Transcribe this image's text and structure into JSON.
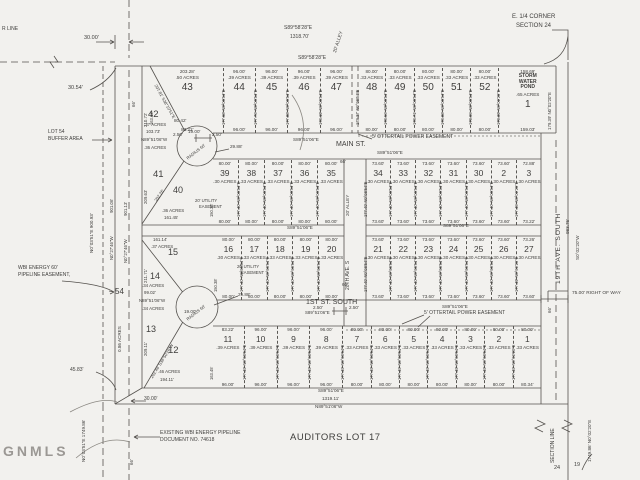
{
  "colors": {
    "bg": "#f2f1ee",
    "ink": "#3f3e3c",
    "line": "#55524e",
    "watermark": "#9b9894"
  },
  "watermark": "GNMLS",
  "an": {
    "r_line": "R LINE",
    "d30_top": "30.00'",
    "d30_54": "30.54'",
    "lot54_l1": "LOT 54",
    "lot54_l2": "BUFFER AREA",
    "b_top1": "S89°58'28\"E",
    "b_top1d": "1318.70'",
    "b_top2": "S89°58'28\"E",
    "alley_top": "20' ALLEY",
    "e14_l1": "E. 1/4 CORNER",
    "e14_l2": "SECTION 24",
    "d80_42": "80.42'",
    "d19_u": "19.00'",
    "d2_50a": "2.50'",
    "d2_50b": "2.50'",
    "d29_88u": "29.88'",
    "radius_u": "RADIUS 60'",
    "radius_l": "RADIUS 60'",
    "main_st": "MAIN ST.",
    "b_main_w": "S89°51'06\"E",
    "b_main_e": "S89°51'06\"E",
    "ott_u": "5' OTTERTAIL POWER EASEMENT",
    "ott_l": "5' OTTERTAIL POWER EASEMENT",
    "u1": ".37 ACRES",
    "u2": "103.73'",
    "u3": "N89°51'06\"W",
    "u4": ".36 ACRES",
    "l1": ".34 ACRES",
    "l2": "99.02'",
    "l3": "N89°51'06\"W",
    "l4": ".34 ACRES",
    "b_mid_w": "S89°51'06\"E",
    "b_mid_e": "S89°51'06\"E",
    "util_1a": "20' UTILITY",
    "util_1b": "EASEMENT",
    "util_2a": "20' UTILITY",
    "util_2b": "EASEMENT",
    "alley_mid": "20' ALLEY",
    "ave20": "20TH AVE. S",
    "first_st": "1ST ST. SOUTH",
    "b_1st": "S89°51'06\"E",
    "b_1st_e": "S89°51'06\"E",
    "d2_50c": "2.50'",
    "d2_50d": "2.50'",
    "d29_88l": "29.88'",
    "d19_l": "19.00'",
    "d66_a": "66'",
    "d66_b": "66'",
    "d66_c": "66'",
    "d66_d": "66'",
    "d66_e": "66'",
    "ave19": "19TH AVE. SOUTH",
    "d983": "983.76'",
    "b_s002": "S0°02'20\"W",
    "d179_39": "179.39' N0°02'20\"E",
    "row_txt": "75.00' RIGHT OF WAY",
    "section_line": "SECTION LINE",
    "d1749_e": "1749.86' N0°02'20\"E",
    "n24": "24",
    "n19": "19",
    "b_bot1": "S89°51'06\"E",
    "d_bot": "1319.11'",
    "b_bot2": "N89°51'06\"W",
    "d30_bot": "30.00'",
    "wbi_l1": "WBI ENERGY 60'",
    "wbi_l2": "PIPELINE EASEMENT,",
    "n54": "54",
    "a086": "0.86 ACRES",
    "d45_83": "45.83'",
    "v900": "N0°03'51\"E 900.93'",
    "v901_06": "901.06'",
    "v9_27a": "N0°27'46\"W",
    "v901_13": "901.13'",
    "v9_27b": "N0°27'46\"W",
    "v1749w": "N0°03'51\"E 1749.86'",
    "exist_l1": "EXISTING WBI ENERGY PIPELINE",
    "exist_l2": "DOCUMENT NO. 74618",
    "auditors": "AUDITORS LOT 17",
    "n42": "42",
    "n41": "41",
    "n40": "40",
    "n15": "15",
    "n14": "14",
    "n13": "13",
    "n12": "12",
    "f40_a": ".36 ACRES",
    "f40_d": "161.45'",
    "f15_d": "161.14'",
    "f15_a": ".37 ACRES",
    "f12_a": ".46 ACRES",
    "f12_d": "194.11'",
    "diag_u": "207.81' S38°10'51\"E",
    "diag_41": "202.26'",
    "diag_l": "202.46' S38°50'26\"W",
    "s210": "210.72'",
    "s209": "209.63'",
    "s211": "211.71'",
    "s209b": "209.11'"
  },
  "rows": [
    {
      "id": "rowAw",
      "ap": "t",
      "lots": [
        {
          "n": "43",
          "t": "203.28'",
          "a": ".50 ACRES",
          "b": "83.22'",
          "s": "163.33'",
          "w": 72
        },
        {
          "n": "44",
          "t": "96.00'",
          "a": ".39 ACRES",
          "b": "96.00'",
          "s": "177.68' N0°08'54\"E",
          "w": 32
        },
        {
          "n": "45",
          "t": "96.00'",
          "a": ".39 ACRES",
          "b": "96.00'",
          "s": "177.76' N0°08'54\"E",
          "w": 32
        },
        {
          "n": "46",
          "t": "96.00'",
          "a": ".39 ACRES",
          "b": "96.00'",
          "s": "177.88' N0°08'54\"E",
          "w": 32
        },
        {
          "n": "47",
          "t": "96.00'",
          "a": ".39 ACRES",
          "b": "96.00'",
          "s": "178.19' N0°08'54\"E",
          "w": 32
        }
      ]
    },
    {
      "id": "rowAe",
      "ap": "t",
      "lots": [
        {
          "n": "48",
          "t": "80.00'",
          "a": ".33 ACRES",
          "b": "80.00'",
          "s": "178.37' N0°08'54\"E",
          "w": 28
        },
        {
          "n": "49",
          "t": "80.00'",
          "a": ".33 ACRES",
          "b": "80.00'",
          "s": "178.56' N0°08'54\"E",
          "w": 28
        },
        {
          "n": "50",
          "t": "80.00'",
          "a": ".33 ACRES",
          "b": "80.00'",
          "s": "178.71' N0°08'54\"E",
          "w": 28
        },
        {
          "n": "51",
          "t": "80.00'",
          "a": ".33 ACRES",
          "b": "80.00'",
          "s": "178.88' N0°08'54\"E",
          "w": 28
        },
        {
          "n": "52",
          "t": "80.00'",
          "a": ".33 ACRES",
          "b": "80.00'",
          "s": "179.05' N0°08'54\"E",
          "w": 28
        },
        {
          "n": "1",
          "nm": [
            "STORM",
            "WATER",
            "POND"
          ],
          "t": "158.69'",
          "a": ".65 ACRES",
          "b": "159.03'",
          "s": "179.39' N0°02'20\"E",
          "w": 58
        }
      ]
    },
    {
      "id": "rowBw",
      "ap": "b",
      "lots": [
        {
          "n": "39",
          "t": "80.00'",
          "a": ".30 ACRES",
          "b": "80.00'",
          "s": "150.38'",
          "w": 26
        },
        {
          "n": "38",
          "t": "80.00'",
          "a": ".33 ACRES",
          "b": "80.00'",
          "s": "177.40' N0°08'54\"E",
          "w": 26
        },
        {
          "n": "37",
          "t": "80.00'",
          "a": ".33 ACRES",
          "b": "80.00'",
          "s": "177.40' N0°08'54\"E",
          "w": 26
        },
        {
          "n": "36",
          "t": "80.00'",
          "a": ".33 ACRES",
          "b": "80.00'",
          "s": "177.40' N0°08'54\"E",
          "w": 26
        },
        {
          "n": "35",
          "t": "80.00'",
          "a": ".33 ACRES",
          "b": "80.00'",
          "s": "177.40' N0°08'54\"E",
          "w": 26
        }
      ]
    },
    {
      "id": "rowBe",
      "ap": "b",
      "lots": [
        {
          "n": "34",
          "t": "73.60'",
          "a": ".30 ACRES",
          "b": "73.60'",
          "s": "177.40' N0°08'54\"E",
          "w": 25
        },
        {
          "n": "33",
          "t": "73.60'",
          "a": ".30 ACRES",
          "b": "73.60'",
          "s": "177.40' N0°08'54\"E",
          "w": 25
        },
        {
          "n": "32",
          "t": "73.60'",
          "a": ".30 ACRES",
          "b": "73.60'",
          "s": "177.40' N0°08'54\"E",
          "w": 25
        },
        {
          "n": "31",
          "t": "73.60'",
          "a": ".30 ACRES",
          "b": "73.60'",
          "s": "177.40' N0°08'54\"E",
          "w": 25
        },
        {
          "n": "30",
          "t": "73.60'",
          "a": ".30 ACRES",
          "b": "73.60'",
          "s": "177.40' N0°08'54\"E",
          "w": 25
        },
        {
          "n": "2",
          "t": "73.60'",
          "a": ".30 ACRES",
          "b": "73.60'",
          "s": "177.40' N0°08'54\"E",
          "w": 25
        },
        {
          "n": "3",
          "t": "72.88'",
          "a": ".30 ACRES",
          "b": "73.22'",
          "s": "177.45' N0°02'20\"E",
          "w": 25
        }
      ]
    },
    {
      "id": "rowCw",
      "ap": "b",
      "lots": [
        {
          "n": "16",
          "t": "80.00'",
          "a": ".30 ACRES",
          "b": "80.00'",
          "s": "150.38'",
          "w": 26
        },
        {
          "n": "17",
          "t": "80.00'",
          "a": ".33 ACRES",
          "b": "80.00'",
          "s": "177.40' N0°08'54\"E",
          "w": 26
        },
        {
          "n": "18",
          "t": "80.00'",
          "a": ".33 ACRES",
          "b": "80.00'",
          "s": "177.40' N0°08'54\"E",
          "w": 26
        },
        {
          "n": "19",
          "t": "80.00'",
          "a": ".33 ACRES",
          "b": "80.00'",
          "s": "177.40' N0°08'54\"E",
          "w": 26
        },
        {
          "n": "20",
          "t": "80.00'",
          "a": ".33 ACRES",
          "b": "80.00'",
          "s": "177.40' N0°08'54\"E",
          "w": 26
        }
      ]
    },
    {
      "id": "rowCe",
      "ap": "b",
      "lots": [
        {
          "n": "21",
          "t": "73.60'",
          "a": ".30 ACRES",
          "b": "73.60'",
          "s": "177.40' N0°08'54\"E",
          "w": 25
        },
        {
          "n": "22",
          "t": "73.60'",
          "a": ".30 ACRES",
          "b": "73.60'",
          "s": "177.40' N0°08'54\"E",
          "w": 25
        },
        {
          "n": "23",
          "t": "73.60'",
          "a": ".30 ACRES",
          "b": "73.60'",
          "s": "177.40' N0°08'54\"E",
          "w": 25
        },
        {
          "n": "24",
          "t": "73.60'",
          "a": ".30 ACRES",
          "b": "73.60'",
          "s": "177.40' N0°08'54\"E",
          "w": 25
        },
        {
          "n": "25",
          "t": "73.60'",
          "a": ".30 ACRES",
          "b": "73.60'",
          "s": "177.40' N0°08'54\"E",
          "w": 25
        },
        {
          "n": "26",
          "t": "73.60'",
          "a": ".30 ACRES",
          "b": "73.60'",
          "s": "177.40' N0°08'54\"E",
          "w": 25
        },
        {
          "n": "27",
          "t": "73.26'",
          "a": ".30 ACRES",
          "b": "73.60'",
          "s": "177.49' N0°02'20\"E",
          "w": 25
        }
      ]
    },
    {
      "id": "rowD",
      "ap": "b",
      "lots": [
        {
          "n": "11",
          "t": "83.22'",
          "a": ".39 ACRES",
          "b": "96.00'",
          "s": "163.45'",
          "w": 29
        },
        {
          "n": "10",
          "t": "96.00'",
          "a": ".39 ACRES",
          "b": "96.00'",
          "s": "177.40' N0°08'54\"E",
          "w": 29
        },
        {
          "n": "9",
          "t": "96.00'",
          "a": ".39 ACRES",
          "b": "96.00'",
          "s": "177.40' N0°08'54\"E",
          "w": 29
        },
        {
          "n": "8",
          "t": "96.00'",
          "a": ".39 ACRES",
          "b": "96.00'",
          "s": "177.40' N0°08'54\"E",
          "w": 29
        },
        {
          "n": "7",
          "t": "80.00'",
          "a": ".33 ACRES",
          "b": "80.00'",
          "s": "177.40' N0°08'54\"E",
          "w": 25
        },
        {
          "n": "6",
          "t": "80.00'",
          "a": ".33 ACRES",
          "b": "80.00'",
          "s": "177.40' N0°08'54\"E",
          "w": 25
        },
        {
          "n": "5",
          "t": "80.00'",
          "a": ".33 ACRES",
          "b": "80.00'",
          "s": "177.40' N0°08'54\"E",
          "w": 25
        },
        {
          "n": "4",
          "t": "80.00'",
          "a": ".33 ACRES",
          "b": "80.00'",
          "s": "177.40' N0°08'54\"E",
          "w": 25
        },
        {
          "n": "3",
          "t": "80.00'",
          "a": ".33 ACRES",
          "b": "80.00'",
          "s": "177.40' N0°08'54\"E",
          "w": 25
        },
        {
          "n": "2",
          "t": "80.00'",
          "a": ".33 ACRES",
          "b": "80.00'",
          "s": "177.40' N0°08'54\"E",
          "w": 25
        },
        {
          "n": "1",
          "t": "80.00'",
          "a": ".33 ACRES",
          "b": "80.34'",
          "s": "177.40' N0°02'20\"E",
          "w": 25
        }
      ]
    }
  ]
}
